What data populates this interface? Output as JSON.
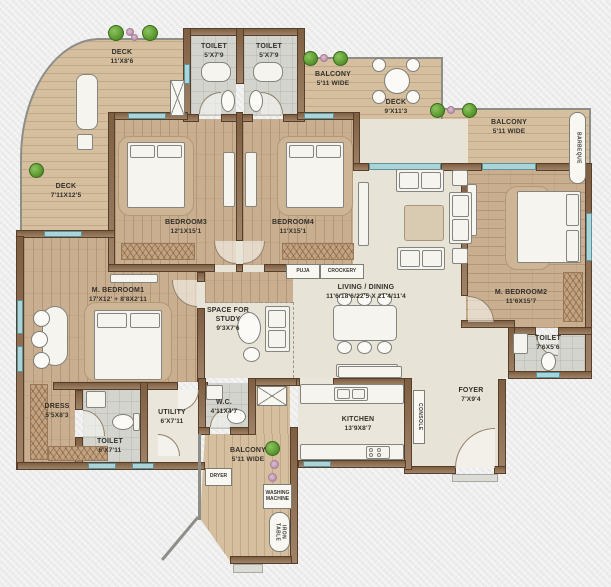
{
  "title": "apartment-floor-plan",
  "rooms": {
    "deck_top": {
      "name": "DECK",
      "dims": "11'X8'6"
    },
    "toilet_top_left": {
      "name": "TOILET",
      "dims": "5'X7'9"
    },
    "toilet_top_right": {
      "name": "TOILET",
      "dims": "5'X7'9"
    },
    "balcony_top": {
      "name": "BALCONY",
      "dims": "5'11 WIDE"
    },
    "deck_center": {
      "name": "DECK",
      "dims": "9'X11'3"
    },
    "balcony_right": {
      "name": "BALCONY",
      "dims": "5'11 WIDE"
    },
    "deck_left": {
      "name": "DECK",
      "dims": "7'11X12'5"
    },
    "bedroom3": {
      "name": "BEDROOM3",
      "dims": "12'1X15'1"
    },
    "bedroom4": {
      "name": "BEDROOM4",
      "dims": "11'X15'1"
    },
    "m_bedroom1": {
      "name": "M. BEDROOM1",
      "dims": "17'X12' + 8'8X2'11"
    },
    "m_bedroom2": {
      "name": "M. BEDROOM2",
      "dims": "11'6X15'7"
    },
    "living_dining": {
      "name": "LIVING / DINING",
      "dims": "11'6/18'6/22'5 X 21'4/11'4"
    },
    "study": {
      "name": "SPACE FOR STUDY",
      "dims": "9'3X7'6"
    },
    "kitchen": {
      "name": "KITCHEN",
      "dims": "13'9X8'7"
    },
    "foyer": {
      "name": "FOYER",
      "dims": "7'X9'4"
    },
    "utility": {
      "name": "UTILITY",
      "dims": "6'X7'11"
    },
    "wc": {
      "name": "W.C.",
      "dims": "4'11X4'7"
    },
    "toilet_m1": {
      "name": "TOILET",
      "dims": "6'X7'11"
    },
    "toilet_m2": {
      "name": "TOILET",
      "dims": "7'6X5'6"
    },
    "dress": {
      "name": "DRESS",
      "dims": "5'5X8'3"
    },
    "balcony_bottom": {
      "name": "BALCONY",
      "dims": "5'11 WIDE"
    }
  },
  "fixtures": {
    "puja": "PUJA",
    "crockery": "CROCKERY",
    "console": "CONSOLE",
    "barbeque": "BARBEQUE",
    "dryer": "DRYER",
    "washing_machine": "WASHING\nMACHINE",
    "iron_table": "IRON\nTABLE"
  },
  "colors": {
    "wall": "#8a6747",
    "wood_floor": "#c9af90",
    "deck_floor": "#d5bf9f",
    "tile_floor": "#d3d4cd",
    "living_floor": "#e8e3d7",
    "window": "#a9d4da",
    "paper": "#ecedec",
    "tree": "#5d9a32",
    "flower": "#bd93ad"
  }
}
